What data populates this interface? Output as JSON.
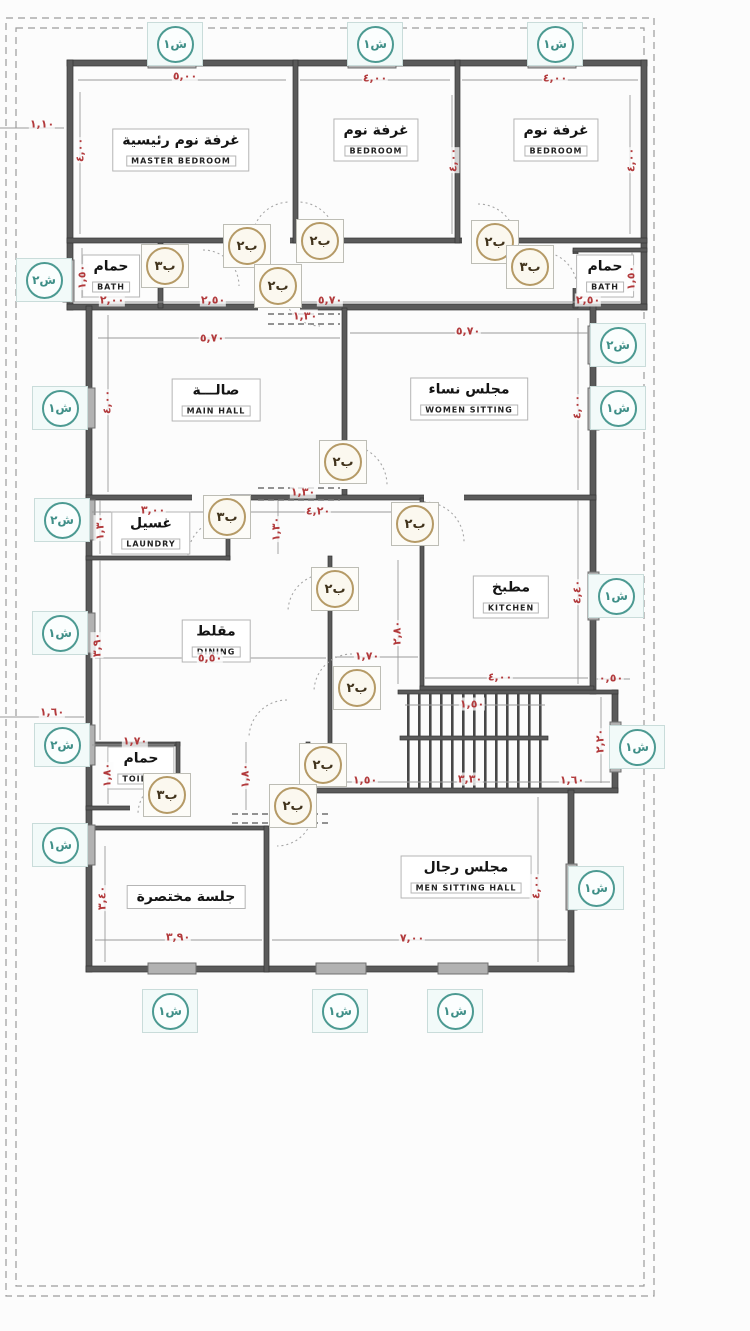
{
  "colors": {
    "wall": "#5a5a5a",
    "dimension_red": "#b23a3c",
    "window_tag_teal": "#3f8f88",
    "door_tag_tan": "#b59a66",
    "boundary_gray": "#9b9b9b"
  },
  "rooms": [
    {
      "name_ar": "غرفة نوم رئيسية",
      "name_en": "MASTER BEDROOM",
      "x": 181,
      "y": 150
    },
    {
      "name_ar": "غرفة نوم",
      "name_en": "BEDROOM",
      "x": 376,
      "y": 140
    },
    {
      "name_ar": "غرفة نوم",
      "name_en": "BEDROOM",
      "x": 556,
      "y": 140
    },
    {
      "name_ar": "حمام",
      "name_en": "BATH",
      "x": 111,
      "y": 276
    },
    {
      "name_ar": "حمام",
      "name_en": "BATH",
      "x": 605,
      "y": 276
    },
    {
      "name_ar": "صالـــة",
      "name_en": "MAIN HALL",
      "x": 216,
      "y": 400
    },
    {
      "name_ar": "مجلس نساء",
      "name_en": "WOMEN SITTING",
      "x": 469,
      "y": 399
    },
    {
      "name_ar": "غسيل",
      "name_en": "LAUNDRY",
      "x": 151,
      "y": 533
    },
    {
      "name_ar": "مطبخ",
      "name_en": "KITCHEN",
      "x": 511,
      "y": 597
    },
    {
      "name_ar": "مقلط",
      "name_en": "DINING",
      "x": 216,
      "y": 641
    },
    {
      "name_ar": "حمام",
      "name_en": "TOILET",
      "x": 141,
      "y": 768
    },
    {
      "name_ar": "جلسة مختصرة",
      "name_en": "",
      "x": 186,
      "y": 897
    },
    {
      "name_ar": "مجلس رجال",
      "name_en": "MEN SITTING HALL",
      "x": 466,
      "y": 877
    }
  ],
  "dimensions": [
    {
      "value": "٥,٠٠",
      "x": 185,
      "y": 76,
      "vertical": false
    },
    {
      "value": "٤,٠٠",
      "x": 375,
      "y": 78,
      "vertical": false
    },
    {
      "value": "٤,٠٠",
      "x": 555,
      "y": 78,
      "vertical": false
    },
    {
      "value": "١,١٠",
      "x": 42,
      "y": 124,
      "vertical": false
    },
    {
      "value": "٢,٠٠",
      "x": 112,
      "y": 300,
      "vertical": false
    },
    {
      "value": "٢,٥٠",
      "x": 213,
      "y": 300,
      "vertical": false
    },
    {
      "value": "٥,٧٠",
      "x": 330,
      "y": 300,
      "vertical": false
    },
    {
      "value": "١,٣٠",
      "x": 305,
      "y": 316,
      "vertical": false
    },
    {
      "value": "٢,٥٠",
      "x": 588,
      "y": 300,
      "vertical": false
    },
    {
      "value": "٥,٧٠",
      "x": 212,
      "y": 338,
      "vertical": false
    },
    {
      "value": "٥,٧٠",
      "x": 468,
      "y": 331,
      "vertical": false
    },
    {
      "value": "١,٣٠",
      "x": 303,
      "y": 492,
      "vertical": false
    },
    {
      "value": "٣,٠٠",
      "x": 153,
      "y": 510,
      "vertical": false
    },
    {
      "value": "٤,٢٠",
      "x": 318,
      "y": 511,
      "vertical": false
    },
    {
      "value": "٥,٥٠",
      "x": 210,
      "y": 658,
      "vertical": false
    },
    {
      "value": "١,٧٠",
      "x": 367,
      "y": 656,
      "vertical": false
    },
    {
      "value": "٤,٠٠",
      "x": 500,
      "y": 677,
      "vertical": false
    },
    {
      "value": "٠,٥٠",
      "x": 611,
      "y": 678,
      "vertical": false
    },
    {
      "value": "١,٥٠",
      "x": 472,
      "y": 704,
      "vertical": false
    },
    {
      "value": "١,٧٠",
      "x": 135,
      "y": 741,
      "vertical": false
    },
    {
      "value": "١,٥٠",
      "x": 365,
      "y": 780,
      "vertical": false
    },
    {
      "value": "٣,٣٠",
      "x": 470,
      "y": 779,
      "vertical": false
    },
    {
      "value": "١,٦٠",
      "x": 572,
      "y": 780,
      "vertical": false
    },
    {
      "value": "١,٦٠",
      "x": 52,
      "y": 712,
      "vertical": false
    },
    {
      "value": "٣,٩٠",
      "x": 178,
      "y": 937,
      "vertical": false
    },
    {
      "value": "٧,٠٠",
      "x": 412,
      "y": 938,
      "vertical": false
    },
    {
      "value": "٤,٠٠",
      "x": 80,
      "y": 150,
      "vertical": true
    },
    {
      "value": "٤,٠٠",
      "x": 453,
      "y": 160,
      "vertical": true
    },
    {
      "value": "٤,٠٠",
      "x": 631,
      "y": 160,
      "vertical": true
    },
    {
      "value": "١,٥٠",
      "x": 82,
      "y": 277,
      "vertical": true
    },
    {
      "value": "١,٥٠",
      "x": 631,
      "y": 278,
      "vertical": true
    },
    {
      "value": "٤,٠٠",
      "x": 107,
      "y": 402,
      "vertical": true
    },
    {
      "value": "٤,٠٠",
      "x": 577,
      "y": 407,
      "vertical": true
    },
    {
      "value": "١,٣٠",
      "x": 100,
      "y": 528,
      "vertical": true
    },
    {
      "value": "١,٣٠",
      "x": 276,
      "y": 529,
      "vertical": true
    },
    {
      "value": "٢,٨٠",
      "x": 397,
      "y": 633,
      "vertical": true
    },
    {
      "value": "٣,٩٠",
      "x": 97,
      "y": 645,
      "vertical": true
    },
    {
      "value": "٤,٤٠",
      "x": 577,
      "y": 592,
      "vertical": true
    },
    {
      "value": "٢,٢٠",
      "x": 600,
      "y": 741,
      "vertical": true
    },
    {
      "value": "١,٨٠",
      "x": 107,
      "y": 775,
      "vertical": true
    },
    {
      "value": "١,٨٠",
      "x": 245,
      "y": 776,
      "vertical": true
    },
    {
      "value": "٣,٤٠",
      "x": 102,
      "y": 898,
      "vertical": true
    },
    {
      "value": "٤,٠٠",
      "x": 536,
      "y": 887,
      "vertical": true
    }
  ],
  "door_tags": [
    {
      "label": "ب٢",
      "x": 247,
      "y": 246
    },
    {
      "label": "ب٢",
      "x": 320,
      "y": 241
    },
    {
      "label": "ب٢",
      "x": 495,
      "y": 242
    },
    {
      "label": "ب٣",
      "x": 165,
      "y": 266
    },
    {
      "label": "ب٣",
      "x": 530,
      "y": 267
    },
    {
      "label": "ب٢",
      "x": 278,
      "y": 286
    },
    {
      "label": "ب٢",
      "x": 343,
      "y": 462
    },
    {
      "label": "ب٣",
      "x": 227,
      "y": 517
    },
    {
      "label": "ب٢",
      "x": 415,
      "y": 524
    },
    {
      "label": "ب٢",
      "x": 335,
      "y": 589
    },
    {
      "label": "ب٢",
      "x": 357,
      "y": 688
    },
    {
      "label": "ب٢",
      "x": 323,
      "y": 765
    },
    {
      "label": "ب٣",
      "x": 167,
      "y": 795
    },
    {
      "label": "ب٢",
      "x": 293,
      "y": 806
    }
  ],
  "window_tags": [
    {
      "label": "ش١",
      "x": 175,
      "y": 44
    },
    {
      "label": "ش١",
      "x": 375,
      "y": 44
    },
    {
      "label": "ش١",
      "x": 555,
      "y": 44
    },
    {
      "label": "ش٢",
      "x": 44,
      "y": 280
    },
    {
      "label": "ش١",
      "x": 60,
      "y": 408
    },
    {
      "label": "ش٢",
      "x": 62,
      "y": 520
    },
    {
      "label": "ش١",
      "x": 60,
      "y": 633
    },
    {
      "label": "ش٢",
      "x": 62,
      "y": 745
    },
    {
      "label": "ش١",
      "x": 60,
      "y": 845
    },
    {
      "label": "ش٢",
      "x": 618,
      "y": 345
    },
    {
      "label": "ش١",
      "x": 618,
      "y": 408
    },
    {
      "label": "ش١",
      "x": 616,
      "y": 596
    },
    {
      "label": "ش١",
      "x": 637,
      "y": 747
    },
    {
      "label": "ش١",
      "x": 596,
      "y": 888
    },
    {
      "label": "ش١",
      "x": 170,
      "y": 1011
    },
    {
      "label": "ش١",
      "x": 340,
      "y": 1011
    },
    {
      "label": "ش١",
      "x": 455,
      "y": 1011
    }
  ]
}
